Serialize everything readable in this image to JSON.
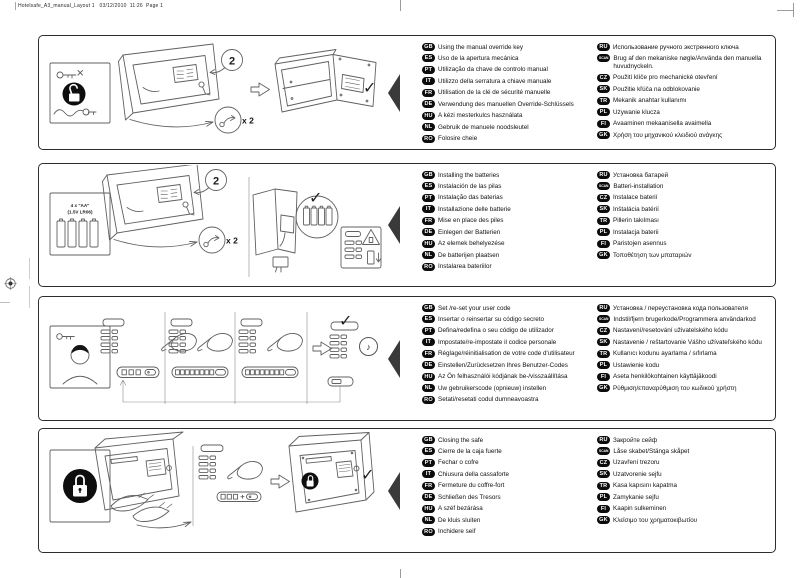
{
  "page": {
    "header": "Hotelsafe_A3_manual_Layout 1   03/12/2010  11:26  Page 1"
  },
  "sections": [
    {
      "id": "using-manual-override-key",
      "annotations": {
        "step": "2",
        "repeat": "x 2",
        "check": "✓"
      },
      "left": [
        {
          "code": "GB",
          "text": "Using the manual override key"
        },
        {
          "code": "ES",
          "text": "Uso de la apertura mecánica"
        },
        {
          "code": "PT",
          "text": "Utilização da chave de controlo manual"
        },
        {
          "code": "IT",
          "text": "Utilizzo della serratura a chiave manuale"
        },
        {
          "code": "FR",
          "text": "Utilisation de la clé de sécurité manuelle"
        },
        {
          "code": "DE",
          "text": "Verwendung des manuellen Override-Schlüssels"
        },
        {
          "code": "HU",
          "text": "A kézi mesterkulcs használata"
        },
        {
          "code": "NL",
          "text": "Gebruik de manuele noodsleutel"
        },
        {
          "code": "RO",
          "text": "Folosire cheie"
        }
      ],
      "right": [
        {
          "code": "RU",
          "text": "Использование ручного экстренного ключа"
        },
        {
          "code": "SCAN",
          "text": "Brug af den mekaniske nøgle/Använda den manuella huvudnyckeln."
        },
        {
          "code": "CZ",
          "text": "Použití klíče pro mechanické otevření"
        },
        {
          "code": "SK",
          "text": "Použitie kľúča na odblokovanie"
        },
        {
          "code": "TR",
          "text": "Mekanik anahtar kullanımı"
        },
        {
          "code": "PL",
          "text": "Używanie klucza"
        },
        {
          "code": "FI",
          "text": "Avaaminen mekaanisella avaimella"
        },
        {
          "code": "GK",
          "text": "Χρήση του μηχανικού κλειδιού ανάγκης"
        }
      ]
    },
    {
      "id": "installing-the-batteries",
      "sidebar": {
        "line1": "4 x \"AA\"",
        "line2": "(1.5V LR06)"
      },
      "annotations": {
        "step": "2",
        "repeat": "x 2",
        "check": "✓"
      },
      "left": [
        {
          "code": "GB",
          "text": "Installing the batteries"
        },
        {
          "code": "ES",
          "text": "Instalación de las pilas"
        },
        {
          "code": "PT",
          "text": "Instalação das baterias"
        },
        {
          "code": "IT",
          "text": "Installazione delle batterie"
        },
        {
          "code": "FR",
          "text": "Mise en place des piles"
        },
        {
          "code": "DE",
          "text": "Einlegen der Batterien"
        },
        {
          "code": "HU",
          "text": "Az elemek behelyezése"
        },
        {
          "code": "NL",
          "text": "De batterijen plaatsen"
        },
        {
          "code": "RO",
          "text": "Instalarea bateriilor"
        }
      ],
      "right": [
        {
          "code": "RU",
          "text": "Установка батарей"
        },
        {
          "code": "SCAN",
          "text": "Batteri-installation"
        },
        {
          "code": "CZ",
          "text": "Instalace baterií"
        },
        {
          "code": "SK",
          "text": "Inštalácia batérií"
        },
        {
          "code": "TR",
          "text": "Pillerin takılması"
        },
        {
          "code": "PL",
          "text": "Instalacja baterii"
        },
        {
          "code": "FI",
          "text": "Paristojen asennus"
        },
        {
          "code": "GK",
          "text": "Τοποθέτηση των μπαταριών"
        }
      ]
    },
    {
      "id": "set-reset-user-code",
      "annotations": {
        "check": "✓",
        "sound": "♪"
      },
      "left": [
        {
          "code": "GB",
          "text": "Set /re-set your user code"
        },
        {
          "code": "ES",
          "text": "Insertar o reinsertar su código secreto"
        },
        {
          "code": "PT",
          "text": "Defina/redefina o seu código de utilizador"
        },
        {
          "code": "IT",
          "text": "Impostate/re-impostate il codice personale"
        },
        {
          "code": "FR",
          "text": "Réglage/réinitialisation de votre code d'utilisateur"
        },
        {
          "code": "DE",
          "text": "Einstellen/Zurücksetzen Ihres Benutzer-Codes"
        },
        {
          "code": "HU",
          "text": "Az Ön felhasználói kódjának be-/visszaállítása"
        },
        {
          "code": "NL",
          "text": "Uw gebruikerscode (opnieuw) instellen"
        },
        {
          "code": "RO",
          "text": "Setati/resetati codul dumneavoastra"
        }
      ],
      "right": [
        {
          "code": "RU",
          "text": "Установка / переустановка кода пользователя"
        },
        {
          "code": "SCAN",
          "text": "Indstil/fjern brugerkode/Programmera användarkod"
        },
        {
          "code": "CZ",
          "text": "Nastavení/resetování uživatelského kódu"
        },
        {
          "code": "SK",
          "text": "Nastavenie / reštartovanie Vášho užívateľského kódu"
        },
        {
          "code": "TR",
          "text": "Kullanıcı kodunu ayarlama / sıfırlama"
        },
        {
          "code": "PL",
          "text": "Ustawienie kodu"
        },
        {
          "code": "FI",
          "text": "Aseta henkilökohtainen käyttäjäkoodi"
        },
        {
          "code": "GK",
          "text": "Ρύθμιση/επαναρύθμιση του κωδικού χρήστη"
        }
      ]
    },
    {
      "id": "closing-the-safe",
      "annotations": {
        "check": "✓"
      },
      "left": [
        {
          "code": "GB",
          "text": "Closing the safe"
        },
        {
          "code": "ES",
          "text": "Cierre de la caja fuerte"
        },
        {
          "code": "PT",
          "text": "Fechar o cofre"
        },
        {
          "code": "IT",
          "text": "Chiusura della cassaforte"
        },
        {
          "code": "FR",
          "text": "Fermeture du coffre-fort"
        },
        {
          "code": "DE",
          "text": "Schließen des Tresors"
        },
        {
          "code": "HU",
          "text": "A széf bezárása"
        },
        {
          "code": "NL",
          "text": "De kluis sluiten"
        },
        {
          "code": "RO",
          "text": "Inchidere seif"
        }
      ],
      "right": [
        {
          "code": "RU",
          "text": "Закройте сейф"
        },
        {
          "code": "SCAN",
          "text": "Låse skabet/Stänga skåpet"
        },
        {
          "code": "CZ",
          "text": "Uzavření trezoru"
        },
        {
          "code": "SK",
          "text": "Uzatvorenie sejfu"
        },
        {
          "code": "TR",
          "text": "Kasa kapısını kapatma"
        },
        {
          "code": "PL",
          "text": "Zamykanie sejfu"
        },
        {
          "code": "FI",
          "text": "Kaapin sulkeminen"
        },
        {
          "code": "GK",
          "text": "Κλείσιμο του χρηματοκιβωτίου"
        }
      ]
    }
  ]
}
